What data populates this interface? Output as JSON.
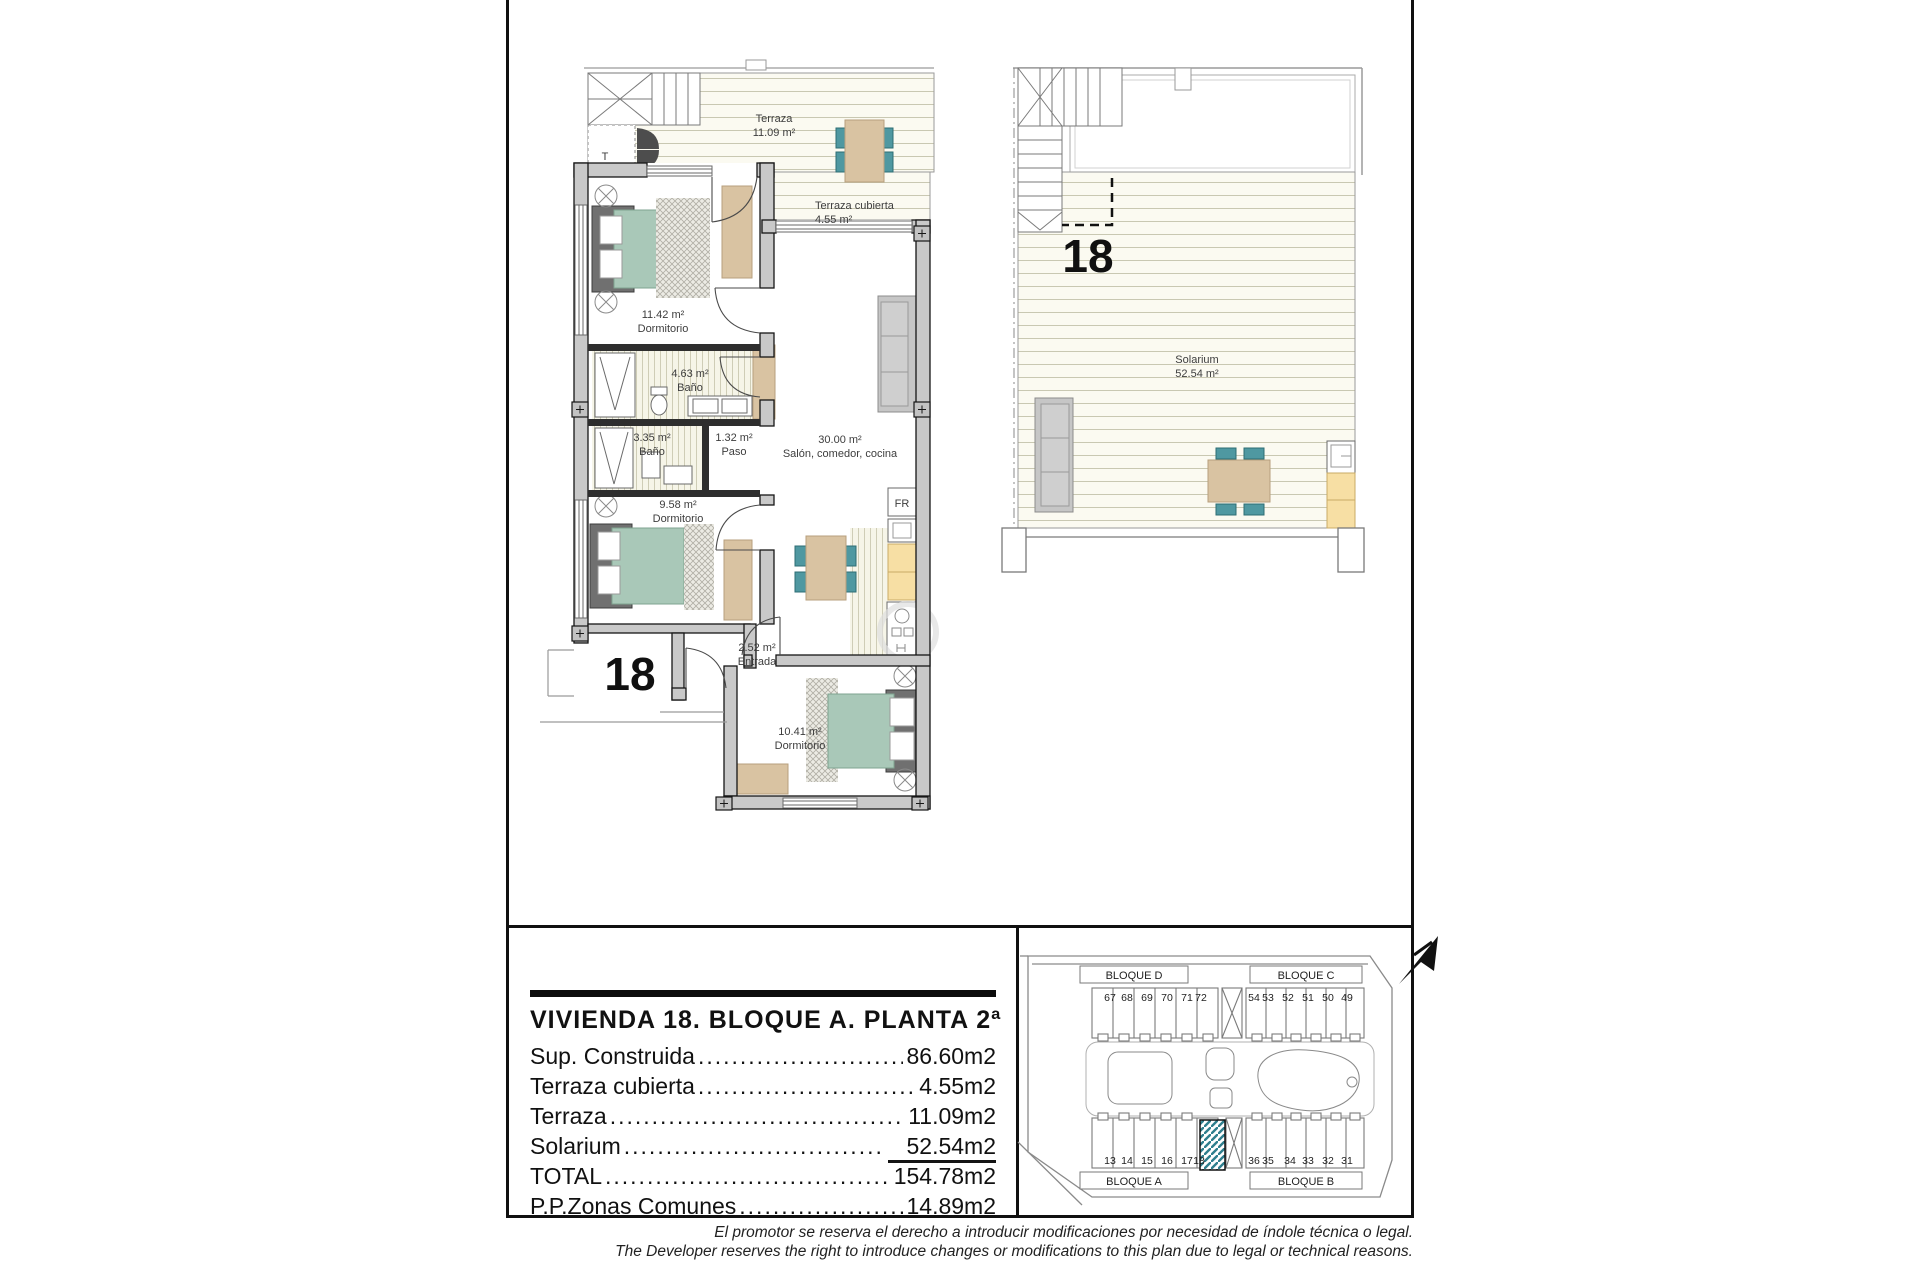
{
  "main_plan": {
    "unit_label": "18",
    "stair_closet_label": "T",
    "fridge_label": "FR",
    "labels": {
      "terraza": {
        "l1": "Terraza",
        "l2": "11.09 m²"
      },
      "terraza_cubierta": {
        "l1": "Terraza cubierta",
        "l2": "4.55 m²"
      },
      "dormitorio_1": {
        "l1": "11.42 m²",
        "l2": "Dormitorio"
      },
      "bano_1": {
        "l1": "4.63 m²",
        "l2": "Baño"
      },
      "bano_2": {
        "l1": "3.35 m²",
        "l2": "Baño"
      },
      "paso": {
        "l1": "1.32 m²",
        "l2": "Paso"
      },
      "salon": {
        "l1": "30.00 m²",
        "l2": "Salón, comedor, cocina"
      },
      "dormitorio_2": {
        "l1": "9.58 m²",
        "l2": "Dormitorio"
      },
      "entrada": {
        "l1": "2.52 m²",
        "l2": "Entrada"
      },
      "dormitorio_3": {
        "l1": "10.41 m²",
        "l2": "Dormitorio"
      }
    }
  },
  "solarium_plan": {
    "unit_label": "18",
    "label": {
      "l1": "Solarium",
      "l2": "52.54 m²"
    }
  },
  "area_table": {
    "title": "VIVIENDA 18. BLOQUE A. PLANTA 2ª",
    "leader_char": ".",
    "rows": [
      {
        "label": "Sup. Construida",
        "value": "86.60m2"
      },
      {
        "label": "Terraza cubierta",
        "value": "4.55m2"
      },
      {
        "label": "Terraza",
        "value": "11.09m2"
      },
      {
        "label": "Solarium",
        "value": "52.54m2"
      },
      {
        "label": "TOTAL",
        "value": "154.78m2"
      },
      {
        "label": "P.P.Zonas Comunes",
        "value": "14.89m2"
      }
    ]
  },
  "site_plan": {
    "highlighted_unit": "18",
    "blocks": [
      {
        "name": "BLOQUE D",
        "units": [
          "67",
          "68",
          "69",
          "70",
          "71",
          "72"
        ]
      },
      {
        "name": "BLOQUE C",
        "units": [
          "54",
          "53",
          "52",
          "51",
          "50",
          "49"
        ]
      },
      {
        "name": "BLOQUE A",
        "units": [
          "13",
          "14",
          "15",
          "16",
          "17",
          "18"
        ]
      },
      {
        "name": "BLOQUE B",
        "units": [
          "36",
          "35",
          "34",
          "33",
          "32",
          "31"
        ]
      }
    ]
  },
  "disclaimer": {
    "es": "El promotor se reserva el derecho a introducir modificaciones por necesidad de índole técnica o legal.",
    "en": "The Developer reserves the right to introduce changes or modifications to this plan due to legal or technical reasons."
  },
  "colors": {
    "wall_fill": "#c9c9c9",
    "line_dark": "#1a1a1a",
    "bed_green": "#a9c8b8",
    "furniture_tan": "#d9c3a2",
    "chair_teal": "#4f98a1",
    "kitchen_yellow": "#f7dfa4",
    "deck_cream": "#fbfaf1",
    "sofa_gray": "#c6c6c6",
    "highlight_teal": "#2f7f8e"
  }
}
